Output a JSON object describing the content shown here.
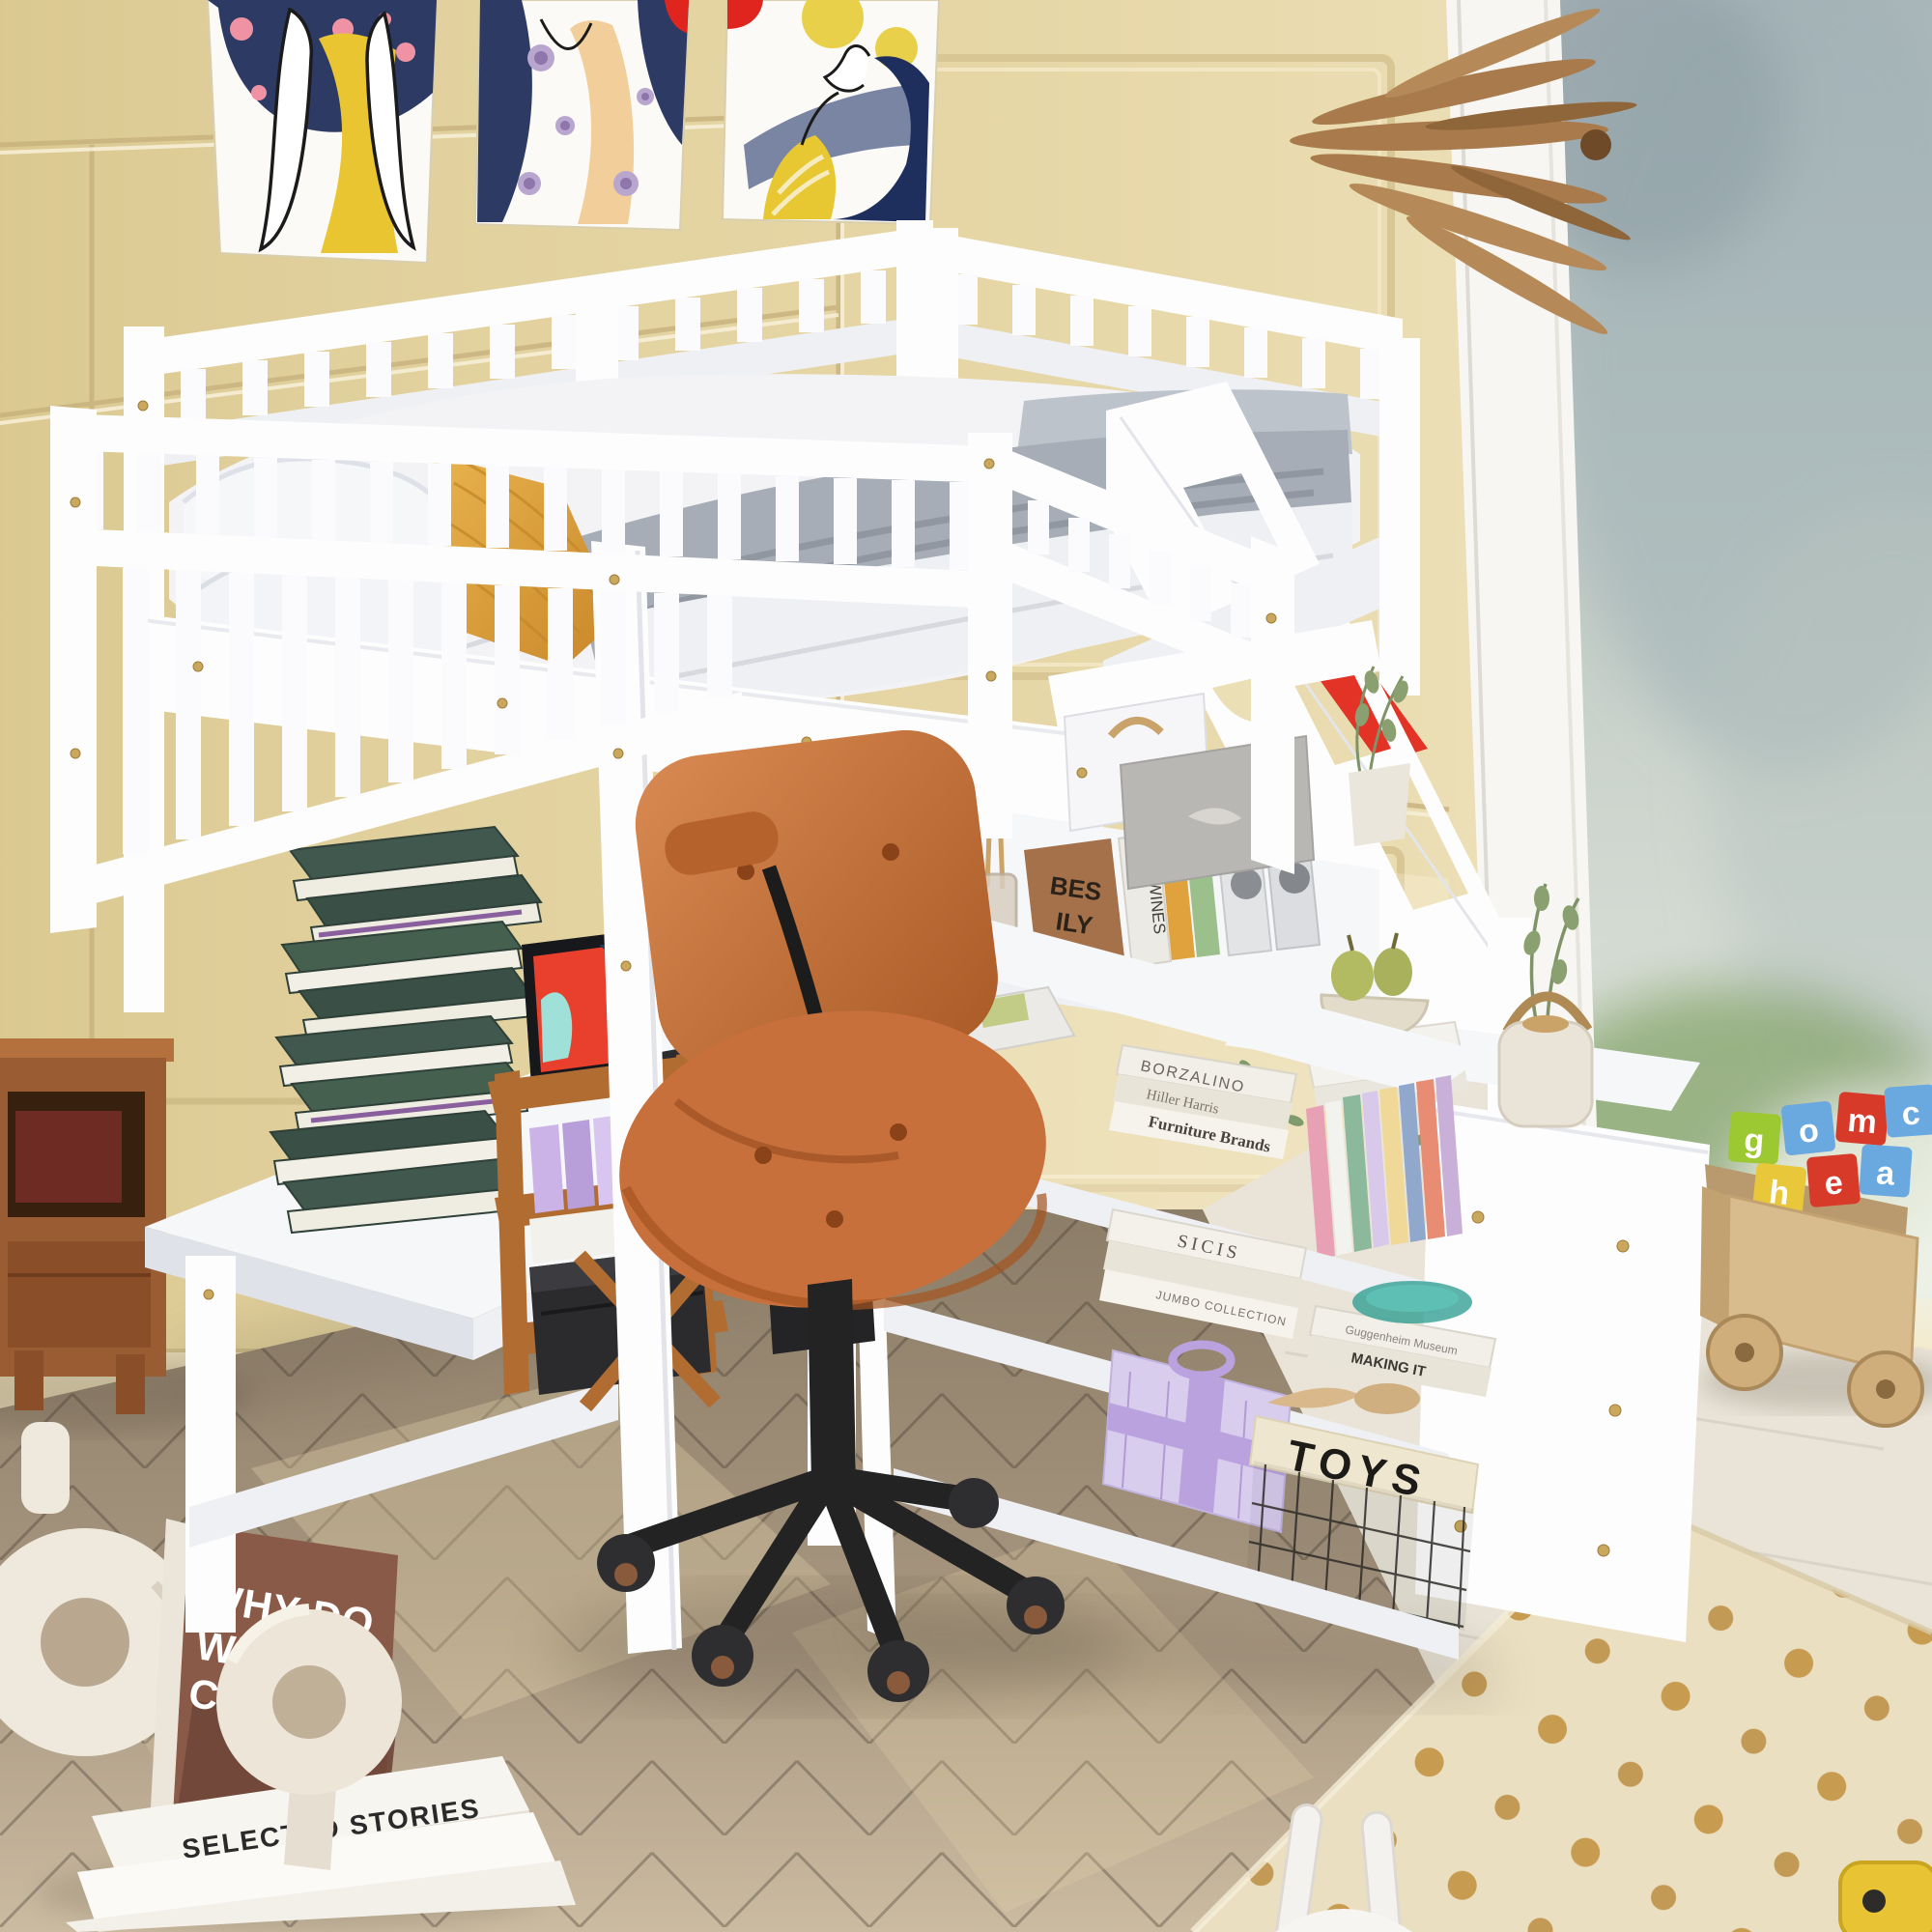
{
  "labels": {
    "book_cats": [
      "WHY DO",
      "WE LOVE",
      "CATS"
    ],
    "selected_stories": "SELECTED STORIES",
    "toys": "TOYS",
    "shelf_stack1": [
      "BORZALINO",
      "Hiller Harris",
      "Furniture Brands"
    ],
    "shelf_stack2": [
      "SICIS",
      "JUMBO COLLECTION"
    ],
    "flat_books": [
      "Guggenheim Museum",
      "MAKING IT"
    ],
    "spine_we_wines": "WE WINES",
    "brown_book": [
      "BES",
      "ILY"
    ],
    "orange_spine": "S1",
    "blocks": [
      "a",
      "o",
      "c",
      "m",
      "e",
      "g",
      "h"
    ]
  },
  "colors": {
    "wall": "#e4d3a0",
    "wall_deep": "#d3c084",
    "floor_wood": "#9b8b74",
    "tile": "#e9e4d7",
    "rug": "#ebdfc2",
    "rug_dot": "#c2913c",
    "bed_white": "#fdfdfe",
    "mattress": "#f3f3f6",
    "blanket_gray": "#a7adb6",
    "pillow_yellow": "#dfa23a",
    "chair_orange": "#c8703c",
    "chair_frame_black": "#232323",
    "wood_accent": "#b06c31",
    "crate_wood": "#d9bc8e",
    "green_book": "#41584e",
    "red_toy": "#e23326",
    "gift_purple": "#d9cdee",
    "teal_glass": "#2f9e92",
    "pear_green": "#b2ba62",
    "tablet_red": "#e8402c",
    "poster_navy": "#2c3a64",
    "poster_yellow": "#e9c531",
    "palm_brown": "#a87a4c"
  }
}
